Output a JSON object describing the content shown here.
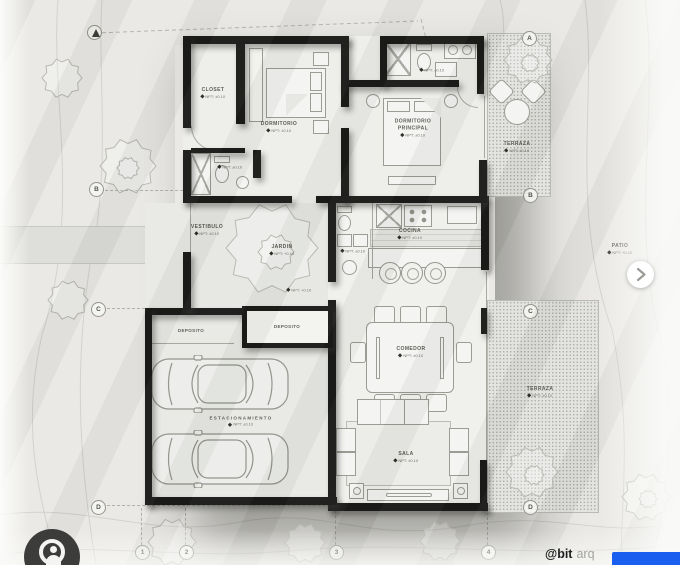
{
  "post": {
    "type_note": "architectural floor plan carousel image",
    "watermark": {
      "bold": "@bit",
      "light": "arq"
    },
    "icons": {
      "carousel_next": "chevron-right",
      "logo": "user-avatar",
      "north": "north-arrow"
    },
    "colors": {
      "paper": "#e9e8e5",
      "wall_black": "#151514",
      "accent_blue": "#1a5ef0",
      "stipple_terrace": "#e2e3df"
    }
  },
  "rooms": {
    "closet": {
      "name": "CLOSET",
      "npt": "NPT: ±0.10"
    },
    "dormitorio": {
      "name": "DORMITORIO",
      "npt": "NPT: ±0.10"
    },
    "dormitorio_principal": {
      "name": "DORMITORIO",
      "name2": "PRINCIPAL",
      "npt": "NPT: ±0.10"
    },
    "terraza_norte": {
      "name": "TERRAZA",
      "npt": "NPT: ±0.10"
    },
    "bano_principal": {
      "npt": "NPT: ±0.10"
    },
    "bano_1": {
      "npt": "NPT: ±0.10"
    },
    "bano_social": {
      "npt": "NPT: ±0.10"
    },
    "cocina": {
      "name": "COCINA",
      "npt": "NPT: ±0.10"
    },
    "vestibulo": {
      "name": "VESTIBULO",
      "npt": "NPT: ±0.10"
    },
    "jardin": {
      "name": "JARDIN",
      "npt": "NPT: +0.10"
    },
    "courtyard_npt": {
      "npt": "NPT: +0.10"
    },
    "comedor": {
      "name": "COMEDOR",
      "npt": "NPT: ±0.10"
    },
    "sala": {
      "name": "SALA",
      "npt": "NPT: ±0.10"
    },
    "terraza_este": {
      "name": "TERRAZA",
      "npt": "NPT: ±0.10"
    },
    "deposito_1": {
      "name": "DEPOSITO"
    },
    "deposito_2": {
      "name": "DEPOSITO"
    },
    "estacionamiento": {
      "name": "ESTACIONAMIENTO",
      "npt": "NPT: ±0.10"
    },
    "patio": {
      "name": "PATIO",
      "npt": "NPT: +0.10"
    }
  },
  "grid_markers": [
    "A",
    "B",
    "B",
    "C",
    "C",
    "D",
    "D",
    "1",
    "2",
    "3",
    "4"
  ]
}
